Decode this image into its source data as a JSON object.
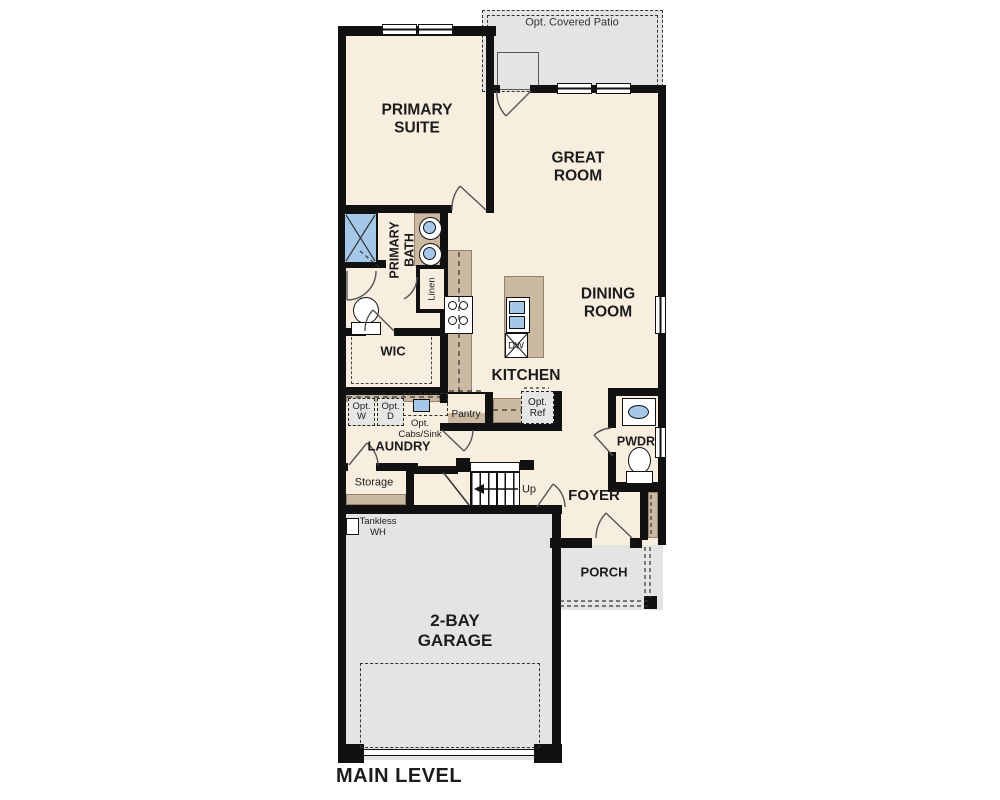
{
  "labels": {
    "patio": "Opt. Covered Patio",
    "primary_suite": "PRIMARY\nSUITE",
    "great_room": "GREAT\nROOM",
    "dining_room": "DINING\nROOM",
    "primary_bath": "PRIMARY\nBATH",
    "linen": "Linen",
    "wic": "WIC",
    "kitchen": "KITCHEN",
    "pantry": "Pantry",
    "opt_ref": "Opt.\nRef",
    "opt_w": "Opt.\nW",
    "opt_d": "Opt.\nD",
    "opt_cabs_sink": "Opt.\nCabs/Sink",
    "laundry": "LAUNDRY",
    "storage": "Storage",
    "up": "Up",
    "dw": "DW",
    "foyer": "FOYER",
    "pwdr": "PWDR",
    "porch": "PORCH",
    "garage": "2-BAY\nGARAGE",
    "tankless": "Tankless\nWH",
    "main_level": "MAIN LEVEL"
  },
  "colors": {
    "floor": "#f7eedf",
    "exterior_surface": "#e4e4e2",
    "cabinetry": "#cbb9a2",
    "fixture_blue": "#a5c7e8",
    "wall": "#111111"
  }
}
